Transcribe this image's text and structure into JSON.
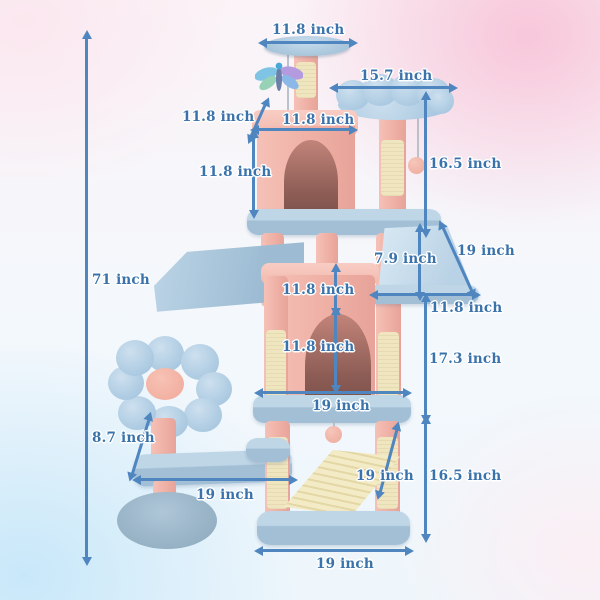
{
  "unit": "inch",
  "annotations": {
    "overall_height": "71 inch",
    "top_perch_width": "11.8 inch",
    "flower_perch_width": "15.7 inch",
    "upper_condo_depth": "11.8 inch",
    "upper_condo_width": "11.8 inch",
    "upper_condo_height": "11.8 inch",
    "flower_post_height": "16.5 inch",
    "hammock_length": "19 inch",
    "hammock_depth": "7.9 inch",
    "hammock_width": "11.8 inch",
    "middle_gap_height": "11.8 inch",
    "lower_condo_height": "11.8 inch",
    "middle_section_height": "17.3 inch",
    "lower_condo_width": "19 inch",
    "flower_stem_height": "8.7 inch",
    "side_platform_width": "19 inch",
    "scratch_ramp_length": "19 inch",
    "bottom_section_height": "16.5 inch",
    "base_width": "19 inch"
  },
  "colors": {
    "annotation_text_blue": "#3a73ab",
    "arrow_blue": "#4f86c0",
    "plush_pink": "#f1b3aa",
    "platform_blue": "#a7c4da",
    "sisal_cream": "#efe5bf",
    "hammock_blue": "#cadeee",
    "flower_blue": "#b3cfe6",
    "flower_center_pink": "#f3b4a8"
  }
}
